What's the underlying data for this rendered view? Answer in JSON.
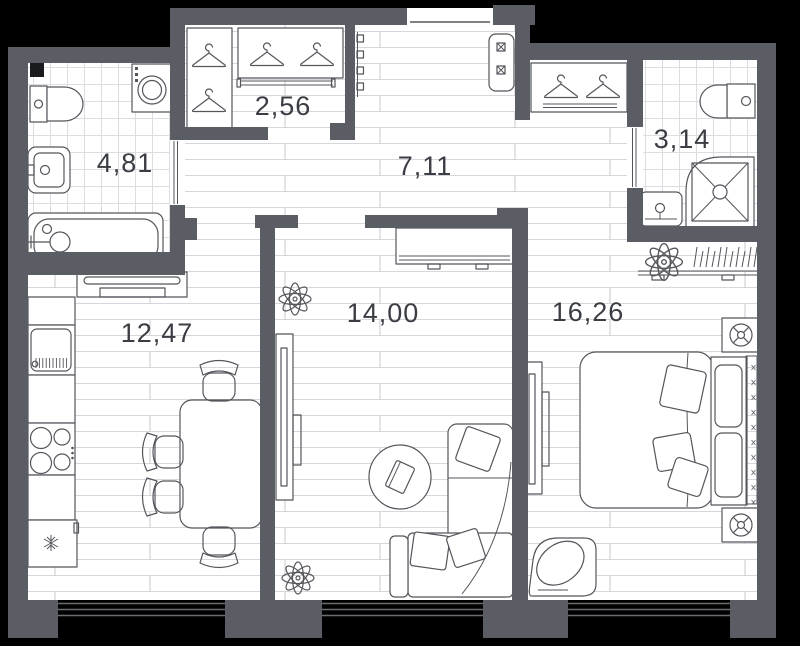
{
  "plan": {
    "type": "apartment-floor-plan",
    "rooms": [
      {
        "name": "bathroom-1",
        "area_label": "4,81"
      },
      {
        "name": "wardrobe",
        "area_label": "2,56"
      },
      {
        "name": "hallway",
        "area_label": "7,11"
      },
      {
        "name": "bathroom-2",
        "area_label": "3,14"
      },
      {
        "name": "kitchen",
        "area_label": "12,47"
      },
      {
        "name": "living-room",
        "area_label": "14,00"
      },
      {
        "name": "bedroom",
        "area_label": "16,26"
      }
    ],
    "colors": {
      "background": "#000000",
      "wall": "#5b5d64",
      "floor": "#ffffff",
      "outline": "#54565c",
      "label_text": "#3b3d44",
      "plank_line": "#d6d7db",
      "tile_line": "#dcdde1"
    }
  }
}
